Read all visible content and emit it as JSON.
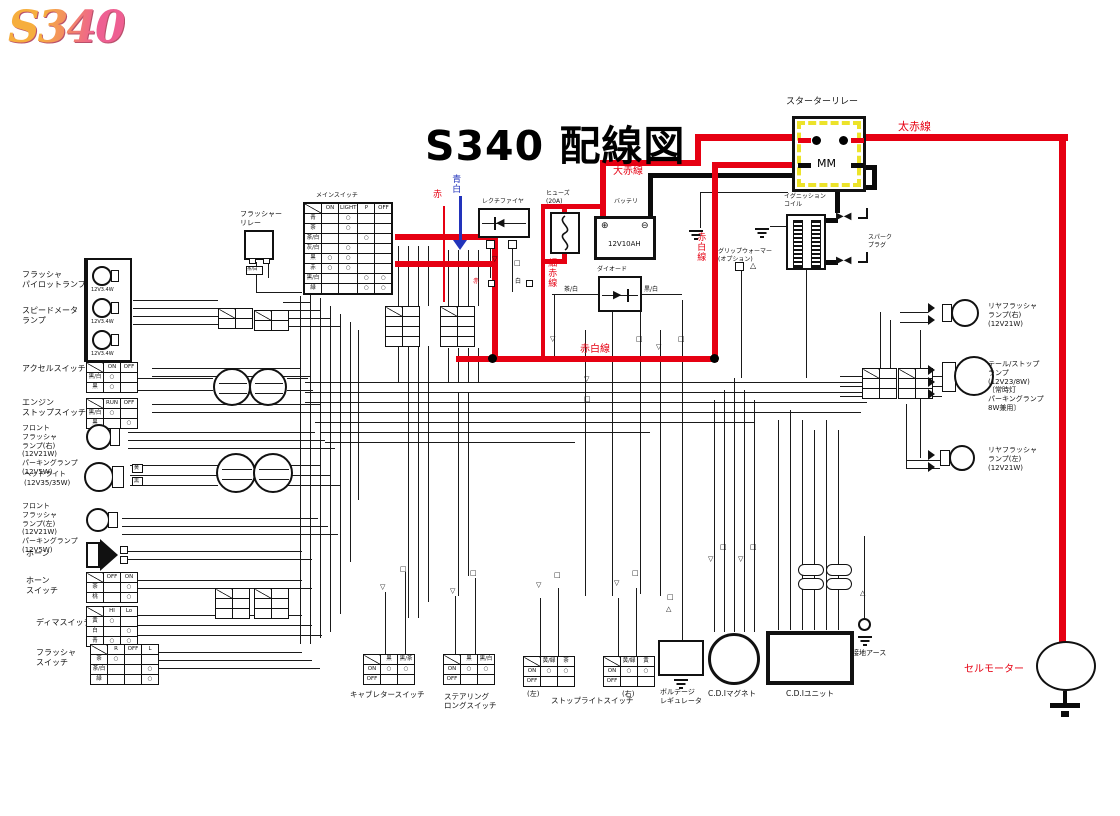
{
  "logo": "S340",
  "title": "S340 配線図",
  "colors": {
    "accent_red": "#e60012",
    "relay_yellow": "#ece32a",
    "arrow_blue": "#2233bb"
  },
  "annotations": {
    "thick_red_top": "太赤線",
    "thick_red_mid": "大赤線",
    "thin_red_line": "細赤線",
    "red_white_line_v": "赤白線",
    "red_white_line_h": "赤白線",
    "red_wire": "赤",
    "blue_white_wire": "青白",
    "red_small": "赤",
    "white_small": "白",
    "brown_white_small": "茶/白",
    "black_white_small": "黒/白",
    "conn_brown_white": "茶/白"
  },
  "top": {
    "starter_relay": {
      "label": "スターターリレー",
      "text": "MM"
    },
    "ignition_coil": {
      "label": "イグニッション\nコイル"
    },
    "spark_plug": {
      "label": "スパーク\nプラグ"
    },
    "rectifier": {
      "label": "レクチファイヤ"
    },
    "fuse": {
      "label": "ヒューズ\n(20A)"
    },
    "battery": {
      "label": "バッテリ",
      "value": "12V10AH",
      "plus": "⊕",
      "minus": "⊖"
    },
    "diode": {
      "label": "ダイオード"
    },
    "grip_warmer": {
      "label": "グリップウォーマー\n(オプション)"
    },
    "flasher_relay": {
      "label": "フラッシャー\nリレー"
    }
  },
  "left": {
    "pilot_lamp_label": "フラッシャ\nパイロットランプ",
    "speedo_lamp_label": "スピードメータ\nランプ",
    "bulbs": [
      "12V3.4W",
      "12V3.4W",
      "12V3.4W"
    ],
    "accel_label": "アクセルスイッチ",
    "engine_stop_label": "エンジン\nストップスイッチ",
    "front_flasher_r_label": "フロント\nフラッシャ\nランプ(右)\n(12V21W)\nパーキングランプ\n(12V5W)",
    "headlight_label": "ヘッドライト\n(12V35/35W)",
    "headlight_codes": [
      "黄",
      "黒"
    ],
    "front_flasher_l_label": "フロント\nフラッシャ\nランプ(左)\n(12V21W)\nパーキングランプ\n(12V5W)",
    "horn_label": "ホーン",
    "horn_switch_label": "ホーン\nスイッチ",
    "dimmer_label": "ディマスイッチ",
    "flasher_switch_label": "フラッシャ\nスイッチ"
  },
  "right": {
    "rear_flasher_r_label": "リヤフラッシャ\nランプ(右)\n(12V21W)",
    "tail_stop_label": "テール/ストップ\nランプ\n(12V23/8W)\n〔常時灯\nパーキングランプ\n8W兼用〕",
    "rear_flasher_l_label": "リヤフラッシャ\nランプ(左)\n(12V21W)"
  },
  "bottom": {
    "carb_label": "キャブレタースイッチ",
    "steering_label": "ステアリング\nロングスイッチ",
    "stop_tag_left": "(左)",
    "stoplight_label": "ストップライトスイッチ",
    "stop_tag_right": "(右)",
    "regulator_label": "ボルテージ\nレギュレータ",
    "cdi_magneto_label": "C.D.Iマグネト",
    "cdi_unit_label": "C.D.Iユニット",
    "ground_label": "接地アース",
    "cell_motor_label": "セルモーター"
  },
  "tables": {
    "main_switch": {
      "title": "メインスイッチ",
      "grid": [
        [
          "",
          "ON",
          "LIGHT",
          "P",
          "OFF"
        ],
        [
          "青",
          "",
          "○",
          "",
          ""
        ],
        [
          "茶",
          "",
          "○",
          "",
          ""
        ],
        [
          "茶/白",
          "",
          "",
          "○",
          ""
        ],
        [
          "灰/白",
          "",
          "○",
          "",
          ""
        ],
        [
          "黒",
          "○",
          "○",
          "",
          ""
        ],
        [
          "赤",
          "○",
          "○",
          "",
          ""
        ],
        [
          "黒/白",
          "",
          "",
          "○",
          "○"
        ],
        [
          "緑",
          "",
          "",
          "○",
          "○"
        ]
      ]
    },
    "accel": {
      "grid": [
        [
          "",
          "ON",
          "OFF"
        ],
        [
          "黒/白",
          "○",
          ""
        ],
        [
          "黒",
          "○",
          ""
        ]
      ]
    },
    "engine_stop": {
      "grid": [
        [
          "",
          "RUN",
          "OFF"
        ],
        [
          "黒/白",
          "○",
          ""
        ],
        [
          "黒",
          "",
          "○"
        ]
      ]
    },
    "horn_switch": {
      "grid": [
        [
          "",
          "OFF",
          "ON"
        ],
        [
          "茶",
          "",
          "○"
        ],
        [
          "桃",
          "",
          "○"
        ]
      ]
    },
    "dimmer": {
      "grid": [
        [
          "",
          "HI",
          "Lo"
        ],
        [
          "黄",
          "○",
          ""
        ],
        [
          "白",
          "",
          "○"
        ],
        [
          "青",
          "○",
          "○"
        ]
      ]
    },
    "flasher_switch": {
      "grid": [
        [
          "",
          "R",
          "OFF",
          "L"
        ],
        [
          "茶",
          "○",
          "",
          ""
        ],
        [
          "茶/白",
          "",
          "",
          "○"
        ],
        [
          "緑",
          "",
          "",
          "○"
        ]
      ]
    },
    "carb": {
      "grid": [
        [
          "",
          "黒",
          "黒/茶"
        ],
        [
          "ON",
          "○",
          "○"
        ],
        [
          "OFF",
          "",
          ""
        ]
      ]
    },
    "steering": {
      "grid": [
        [
          "",
          "黒",
          "黒/白"
        ],
        [
          "ON",
          "○",
          "○"
        ],
        [
          "OFF",
          "",
          ""
        ]
      ]
    },
    "stop_left": {
      "grid": [
        [
          "",
          "黄/緑",
          "茶"
        ],
        [
          "ON",
          "○",
          "○"
        ],
        [
          "OFF",
          "",
          ""
        ]
      ]
    },
    "stop_right": {
      "grid": [
        [
          "",
          "黄/緑",
          "黄"
        ],
        [
          "ON",
          "○",
          "○"
        ],
        [
          "OFF",
          "",
          ""
        ]
      ]
    },
    "conn2x2": {
      "grid": [
        [
          "",
          ""
        ],
        [
          "",
          ""
        ]
      ]
    },
    "conn2x3": {
      "grid": [
        [
          "",
          ""
        ],
        [
          "",
          ""
        ],
        [
          "",
          ""
        ]
      ]
    },
    "conn2x4": {
      "grid": [
        [
          "",
          ""
        ],
        [
          "",
          ""
        ],
        [
          "",
          ""
        ],
        [
          "",
          ""
        ]
      ]
    }
  }
}
